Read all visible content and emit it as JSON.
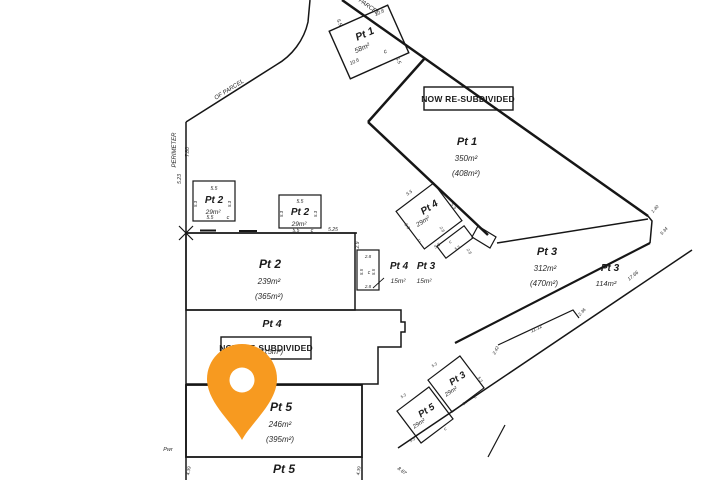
{
  "map": {
    "type": "cadastral-survey-plan",
    "pin_color": "#F79A20",
    "boxes": [
      {
        "name": "resubdivided-box-top",
        "label": "NOW RE-SUBDIVIDED",
        "x": 424,
        "y": 87,
        "w": 89,
        "h": 23,
        "tx": 468,
        "ty": 102,
        "fs": 8.5
      },
      {
        "name": "resubdivided-box-bottom",
        "label": "NOW RE-SUBDIVIDED",
        "x": 221,
        "y": 337,
        "w": 90,
        "h": 22,
        "tx": 266,
        "ty": 351,
        "fs": 8.5
      }
    ],
    "annotations": [
      {
        "name": "parcel-pt1-58-label",
        "text": "Pt 1",
        "x": 366,
        "y": 37,
        "rot": -24,
        "fs": 10.5,
        "cls": "parcel"
      },
      {
        "name": "parcel-pt1-58-area",
        "text": "58m²",
        "x": 363,
        "y": 50,
        "rot": -24,
        "fs": 7,
        "cls": "dim"
      },
      {
        "name": "parcel-pt1-58-c-mark",
        "text": "c",
        "x": 386,
        "y": 53,
        "rot": -24,
        "fs": 6,
        "cls": "dim"
      },
      {
        "name": "dim-5-5",
        "text": "5.5",
        "x": 338,
        "y": 23,
        "rot": 66,
        "fs": 5,
        "cls": "dim"
      },
      {
        "name": "dim-10-8",
        "text": "10.8",
        "x": 380,
        "y": 14,
        "rot": -24,
        "fs": 5,
        "cls": "dim"
      },
      {
        "name": "dim-10-6",
        "text": "10.6",
        "x": 355,
        "y": 63,
        "rot": -24,
        "fs": 5,
        "cls": "dim"
      },
      {
        "name": "dim-5-5",
        "text": "5.5",
        "x": 397,
        "y": 61,
        "rot": 66,
        "fs": 5,
        "cls": "dim"
      },
      {
        "name": "perimeter-text-parcel",
        "text": "PARCEL",
        "x": 368,
        "y": 8,
        "rot": 35,
        "fs": 6,
        "cls": "dim"
      },
      {
        "name": "perimeter-text-of-parcel",
        "text": "OF PARCEL",
        "x": 230,
        "y": 91,
        "rot": -32,
        "fs": 6,
        "cls": "dim"
      },
      {
        "name": "perimeter-text",
        "text": "PERIMETER",
        "x": 176,
        "y": 150,
        "rot": -90,
        "fs": 6,
        "cls": "dim"
      },
      {
        "name": "dim-7-80",
        "text": "7.80",
        "x": 189,
        "y": 152,
        "rot": -90,
        "fs": 5,
        "cls": "dim"
      },
      {
        "name": "dim-5-23",
        "text": "5.23",
        "x": 181,
        "y": 179,
        "rot": -90,
        "fs": 5,
        "cls": "dim"
      },
      {
        "name": "dim-5-5",
        "text": "5.5",
        "x": 214,
        "y": 190,
        "rot": 0,
        "fs": 5,
        "cls": "dim"
      },
      {
        "name": "parcel-pt2-29a-label",
        "text": "Pt 2",
        "x": 214,
        "y": 203,
        "rot": 0,
        "fs": 10,
        "cls": "parcel"
      },
      {
        "name": "parcel-pt2-29a-area",
        "text": "29m²",
        "x": 213,
        "y": 214,
        "rot": 0,
        "fs": 6.5,
        "cls": "dim"
      },
      {
        "name": "dim-5-3",
        "text": "5.3",
        "x": 197,
        "y": 204,
        "rot": -90,
        "fs": 4.5,
        "cls": "dim"
      },
      {
        "name": "dim-5-3",
        "text": "5.3",
        "x": 231,
        "y": 204,
        "rot": -90,
        "fs": 4.5,
        "cls": "dim"
      },
      {
        "name": "dim-5-5",
        "text": "5.5",
        "x": 210,
        "y": 219,
        "rot": 0,
        "fs": 5,
        "cls": "dim"
      },
      {
        "name": "c-mark",
        "text": "c",
        "x": 228,
        "y": 219,
        "rot": 0,
        "fs": 5.5,
        "cls": "dim"
      },
      {
        "name": "dim-5-5",
        "text": "5.5",
        "x": 300,
        "y": 203,
        "rot": 0,
        "fs": 5,
        "cls": "dim"
      },
      {
        "name": "parcel-pt2-29b-label",
        "text": "Pt 2",
        "x": 300,
        "y": 215,
        "rot": 0,
        "fs": 10,
        "cls": "parcel"
      },
      {
        "name": "parcel-pt2-29b-area",
        "text": "29m²",
        "x": 299,
        "y": 226,
        "rot": 0,
        "fs": 6.5,
        "cls": "dim"
      },
      {
        "name": "dim-5-3",
        "text": "5.3",
        "x": 283,
        "y": 214,
        "rot": -90,
        "fs": 4.5,
        "cls": "dim"
      },
      {
        "name": "dim-5-3",
        "text": "5.3",
        "x": 317,
        "y": 214,
        "rot": -90,
        "fs": 4.5,
        "cls": "dim"
      },
      {
        "name": "dim-5-5",
        "text": "5.5",
        "x": 296,
        "y": 232,
        "rot": 0,
        "fs": 5,
        "cls": "dim"
      },
      {
        "name": "c-mark",
        "text": "c",
        "x": 312,
        "y": 232,
        "rot": 0,
        "fs": 5.5,
        "cls": "dim"
      },
      {
        "name": "dim-5-25",
        "text": "5.25",
        "x": 333,
        "y": 231,
        "rot": 0,
        "fs": 5,
        "cls": "dim"
      },
      {
        "name": "parcel-pt2-main-label",
        "text": "Pt 2",
        "x": 270,
        "y": 268,
        "rot": 0,
        "fs": 12,
        "cls": "parcel"
      },
      {
        "name": "parcel-pt2-main-area",
        "text": "239m²",
        "x": 269,
        "y": 284,
        "rot": 0,
        "fs": 8,
        "cls": "dim"
      },
      {
        "name": "parcel-pt2-main-area2",
        "text": "(365m²)",
        "x": 269,
        "y": 299,
        "rot": 0,
        "fs": 8,
        "cls": "dim"
      },
      {
        "name": "dim-2-9",
        "text": "2.9",
        "x": 359,
        "y": 245,
        "rot": -90,
        "fs": 5,
        "cls": "dim"
      },
      {
        "name": "dim-2-8",
        "text": "2.8",
        "x": 368,
        "y": 258,
        "rot": 0,
        "fs": 4.5,
        "cls": "dim"
      },
      {
        "name": "dim-5-5",
        "text": "5.5",
        "x": 363,
        "y": 272,
        "rot": -90,
        "fs": 4.5,
        "cls": "dim"
      },
      {
        "name": "c-mark",
        "text": "c",
        "x": 369,
        "y": 274,
        "rot": 0,
        "fs": 5,
        "cls": "dim"
      },
      {
        "name": "dim-5-5",
        "text": "5.5",
        "x": 375,
        "y": 272,
        "rot": -90,
        "fs": 4.5,
        "cls": "dim"
      },
      {
        "name": "dim-2-8",
        "text": "2.8",
        "x": 368,
        "y": 288,
        "rot": 0,
        "fs": 4.5,
        "cls": "dim"
      },
      {
        "name": "parcel-pt4-15-label",
        "text": "Pt 4",
        "x": 399,
        "y": 269,
        "rot": 0,
        "fs": 10,
        "cls": "parcel"
      },
      {
        "name": "parcel-pt4-15-area",
        "text": "15m²",
        "x": 398,
        "y": 283,
        "rot": 0,
        "fs": 6.5,
        "cls": "dim"
      },
      {
        "name": "parcel-pt3-15-label",
        "text": "Pt 3",
        "x": 426,
        "y": 269,
        "rot": 0,
        "fs": 10,
        "cls": "parcel"
      },
      {
        "name": "parcel-pt3-15-area",
        "text": "15m²",
        "x": 424,
        "y": 283,
        "rot": 0,
        "fs": 6.5,
        "cls": "dim"
      },
      {
        "name": "parcel-pt4-main-label",
        "text": "Pt 4",
        "x": 272,
        "y": 327,
        "rot": 0,
        "fs": 10.5,
        "cls": "parcel"
      },
      {
        "name": "parcel-pt4-main-area2",
        "text": "(315m²)",
        "x": 270,
        "y": 354,
        "rot": 0,
        "fs": 7.5,
        "cls": "dim"
      },
      {
        "name": "parcel-pt5-main-label",
        "text": "Pt 5",
        "x": 281,
        "y": 411,
        "rot": 0,
        "fs": 12,
        "cls": "parcel"
      },
      {
        "name": "parcel-pt5-main-area",
        "text": "246m²",
        "x": 280,
        "y": 427,
        "rot": 0,
        "fs": 8,
        "cls": "dim"
      },
      {
        "name": "parcel-pt5-main-area2",
        "text": "(395m²)",
        "x": 280,
        "y": 442,
        "rot": 0,
        "fs": 8,
        "cls": "dim"
      },
      {
        "name": "parcel-pt5-bottom-label",
        "text": "Pt 5",
        "x": 284,
        "y": 473,
        "rot": 0,
        "fs": 12,
        "cls": "parcel"
      },
      {
        "name": "pwr-text",
        "text": "Pwr",
        "x": 168,
        "y": 451,
        "rot": 0,
        "fs": 5.5,
        "cls": "dim"
      },
      {
        "name": "dim-4-39",
        "text": "4.39",
        "x": 190,
        "y": 471,
        "rot": -80,
        "fs": 4.5,
        "cls": "dim"
      },
      {
        "name": "dim-4-39",
        "text": "4.39",
        "x": 360,
        "y": 471,
        "rot": -80,
        "fs": 4.5,
        "cls": "dim"
      },
      {
        "name": "dim-8-87",
        "text": "8.87",
        "x": 401,
        "y": 472,
        "rot": 38,
        "fs": 5,
        "cls": "dim"
      },
      {
        "name": "parcel-pt1-main-label",
        "text": "Pt 1",
        "x": 467,
        "y": 145,
        "rot": 0,
        "fs": 11,
        "cls": "parcel"
      },
      {
        "name": "parcel-pt1-main-area",
        "text": "350m²",
        "x": 466,
        "y": 161,
        "rot": 0,
        "fs": 8,
        "cls": "dim"
      },
      {
        "name": "parcel-pt1-main-area2",
        "text": "(408m²)",
        "x": 466,
        "y": 176,
        "rot": 0,
        "fs": 8,
        "cls": "dim"
      },
      {
        "name": "parcel-pt4-29-label",
        "text": "Pt 4",
        "x": 431,
        "y": 210,
        "rot": -33,
        "fs": 10,
        "cls": "parcel"
      },
      {
        "name": "parcel-pt4-29-area",
        "text": "29m²",
        "x": 424,
        "y": 223,
        "rot": -33,
        "fs": 6.5,
        "cls": "dim"
      },
      {
        "name": "dim-5-5",
        "text": "5.5",
        "x": 410,
        "y": 194,
        "rot": -33,
        "fs": 4.5,
        "cls": "dim"
      },
      {
        "name": "dim-5-3",
        "text": "5.3",
        "x": 452,
        "y": 207,
        "rot": 57,
        "fs": 4.5,
        "cls": "dim"
      },
      {
        "name": "dim-5-3",
        "text": "5.3",
        "x": 406,
        "y": 227,
        "rot": 57,
        "fs": 4.5,
        "cls": "dim"
      },
      {
        "name": "c-mark",
        "text": "c",
        "x": 420,
        "y": 242,
        "rot": -33,
        "fs": 5,
        "cls": "dim"
      },
      {
        "name": "dim-5-5",
        "text": "5.5",
        "x": 438,
        "y": 247,
        "rot": -33,
        "fs": 4.5,
        "cls": "dim"
      },
      {
        "name": "dim-2-8",
        "text": "2.8",
        "x": 441,
        "y": 230,
        "rot": 57,
        "fs": 4,
        "cls": "dim"
      },
      {
        "name": "c-mark",
        "text": "c",
        "x": 451,
        "y": 243,
        "rot": -33,
        "fs": 4.5,
        "cls": "dim"
      },
      {
        "name": "dim-5-5",
        "text": "5.5",
        "x": 458,
        "y": 249,
        "rot": -33,
        "fs": 4,
        "cls": "dim"
      },
      {
        "name": "dim-2-8",
        "text": "2.8",
        "x": 468,
        "y": 252,
        "rot": 57,
        "fs": 4,
        "cls": "dim"
      },
      {
        "name": "parcel-pt3-312-label",
        "text": "Pt 3",
        "x": 547,
        "y": 255,
        "rot": 0,
        "fs": 11,
        "cls": "parcel"
      },
      {
        "name": "parcel-pt3-312-area",
        "text": "312m²",
        "x": 545,
        "y": 271,
        "rot": 0,
        "fs": 8,
        "cls": "dim"
      },
      {
        "name": "parcel-pt3-312-area2",
        "text": "(470m²)",
        "x": 544,
        "y": 286,
        "rot": 0,
        "fs": 8,
        "cls": "dim"
      },
      {
        "name": "parcel-pt3-114-label",
        "text": "Pt 3",
        "x": 610,
        "y": 271,
        "rot": 0,
        "fs": 10,
        "cls": "parcel"
      },
      {
        "name": "parcel-pt3-114-area",
        "text": "114m²",
        "x": 606,
        "y": 286,
        "rot": 0,
        "fs": 7.5,
        "cls": "dim"
      },
      {
        "name": "dim-17-66",
        "text": "17.66",
        "x": 634,
        "y": 277,
        "rot": -40,
        "fs": 5,
        "cls": "dim"
      },
      {
        "name": "dim-1-40",
        "text": "1.40",
        "x": 656,
        "y": 210,
        "rot": -47,
        "fs": 4.5,
        "cls": "dim"
      },
      {
        "name": "dim-5-34",
        "text": "5.34",
        "x": 665,
        "y": 232,
        "rot": -47,
        "fs": 4.5,
        "cls": "dim"
      },
      {
        "name": "dim-2-42",
        "text": "2.42",
        "x": 497,
        "y": 351,
        "rot": -62,
        "fs": 4.5,
        "cls": "dim"
      },
      {
        "name": "dim-11-12",
        "text": "11.12",
        "x": 537,
        "y": 330,
        "rot": -26,
        "fs": 5,
        "cls": "dim"
      },
      {
        "name": "dim-2-36",
        "text": "2.36",
        "x": 583,
        "y": 313,
        "rot": -47,
        "fs": 4.5,
        "cls": "dim"
      },
      {
        "name": "parcel-pt3-29-label",
        "text": "Pt 3",
        "x": 459,
        "y": 381,
        "rot": -33,
        "fs": 9.5,
        "cls": "parcel"
      },
      {
        "name": "parcel-pt3-29-area",
        "text": "29m²",
        "x": 452,
        "y": 393,
        "rot": -33,
        "fs": 6,
        "cls": "dim"
      },
      {
        "name": "c-mark",
        "text": "c",
        "x": 476,
        "y": 398,
        "rot": -33,
        "fs": 4.5,
        "cls": "dim"
      },
      {
        "name": "dim-5-3",
        "text": "5.3",
        "x": 435,
        "y": 366,
        "rot": -33,
        "fs": 4,
        "cls": "dim"
      },
      {
        "name": "dim-5-3",
        "text": "5.3",
        "x": 479,
        "y": 380,
        "rot": 57,
        "fs": 4,
        "cls": "dim"
      },
      {
        "name": "dim-5-7",
        "text": "5.7",
        "x": 466,
        "y": 404,
        "rot": -33,
        "fs": 4,
        "cls": "dim"
      },
      {
        "name": "parcel-pt5-29-label",
        "text": "Pt 5",
        "x": 428,
        "y": 413,
        "rot": -33,
        "fs": 9.5,
        "cls": "parcel"
      },
      {
        "name": "parcel-pt5-29-area",
        "text": "29m²",
        "x": 420,
        "y": 425,
        "rot": -33,
        "fs": 6,
        "cls": "dim"
      },
      {
        "name": "c-mark",
        "text": "c",
        "x": 446,
        "y": 430,
        "rot": -33,
        "fs": 4.5,
        "cls": "dim"
      },
      {
        "name": "dim-5-3",
        "text": "5.3",
        "x": 404,
        "y": 397,
        "rot": -33,
        "fs": 4,
        "cls": "dim"
      },
      {
        "name": "dim-5-3",
        "text": "5.3",
        "x": 413,
        "y": 441,
        "rot": -33,
        "fs": 4,
        "cls": "dim"
      }
    ]
  }
}
